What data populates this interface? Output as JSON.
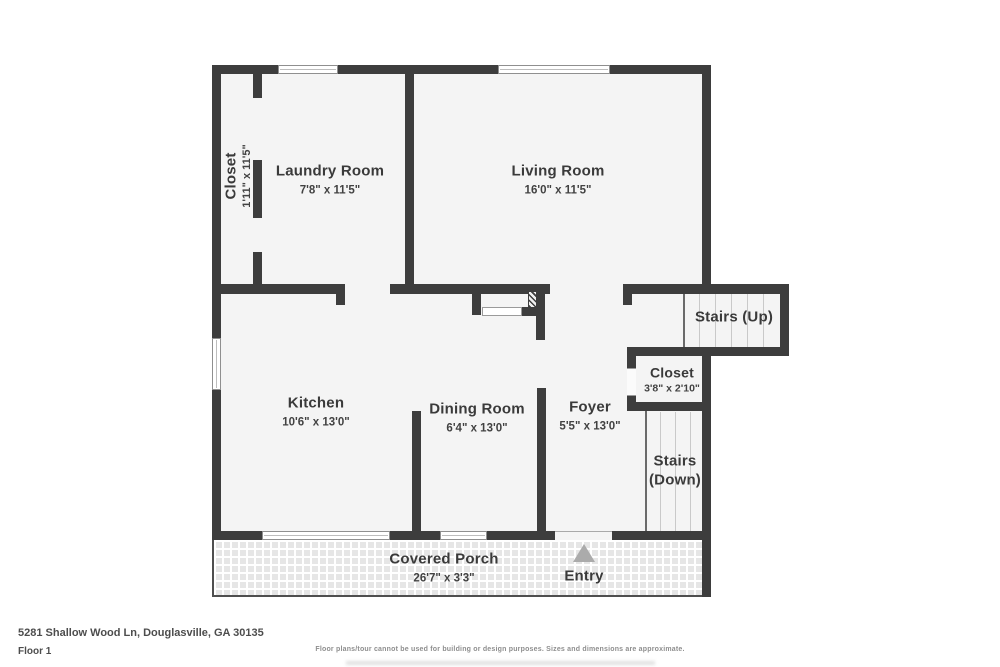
{
  "colors": {
    "wall": "#3d3d3d",
    "floor": "#f4f4f4",
    "label_text": "#3a3a3a",
    "stair_tread": "#c9c9c9",
    "porch_tile": "#e6e6e6",
    "entry_arrow": "#ababab"
  },
  "plan": {
    "rooms": {
      "closet_left": {
        "name": "Closet",
        "dims": "1'11\" x 11'5\""
      },
      "laundry": {
        "name": "Laundry Room",
        "dims": "7'8\" x 11'5\""
      },
      "living": {
        "name": "Living Room",
        "dims": "16'0\" x 11'5\""
      },
      "stairs_up": {
        "name": "Stairs (Up)"
      },
      "closet_right": {
        "name": "Closet",
        "dims": "3'8\" x 2'10\""
      },
      "kitchen": {
        "name": "Kitchen",
        "dims": "10'6\" x 13'0\""
      },
      "dining": {
        "name": "Dining Room",
        "dims": "6'4\" x 13'0\""
      },
      "foyer": {
        "name": "Foyer",
        "dims": "5'5\" x 13'0\""
      },
      "stairs_down": {
        "line1": "Stairs",
        "line2": "(Down)"
      },
      "porch": {
        "name": "Covered Porch",
        "dims": "26'7\" x 3'3\""
      },
      "entry": {
        "name": "Entry"
      }
    }
  },
  "footer": {
    "address": "5281 Shallow Wood Ln, Douglasville, GA 30135",
    "floor_label": "Floor 1",
    "disclaimer": "Floor plans/tour cannot be used for building or design purposes. Sizes and dimensions are approximate."
  }
}
